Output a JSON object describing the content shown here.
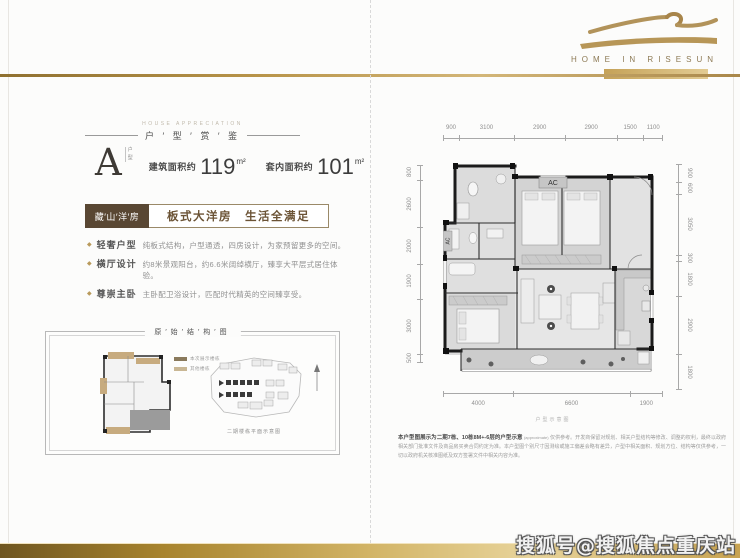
{
  "logo": {
    "wordmark": "HOME IN RISESUN"
  },
  "watermark": {
    "text": "搜狐号@搜狐焦点重庆站"
  },
  "left_panel": {
    "section_header": {
      "en": "HOUSE APPRECIATION",
      "zh": "户 ′ 型 ′ 赏 ′ 鉴"
    },
    "unit": {
      "letter": "A",
      "letter_tag": "户型",
      "areas": [
        {
          "label": "建筑面积约",
          "value": "119",
          "unit": "m²"
        },
        {
          "label": "套内面积约",
          "value": "101",
          "unit": "m²"
        }
      ]
    },
    "banner": {
      "tag": "藏′山′洋′房",
      "slogan": "板式大洋房　生活全满足"
    },
    "features": [
      {
        "title": "轻奢户型",
        "desc": "纯板式结构，户型通透，四房设计，为家预留更多的空间。"
      },
      {
        "title": "横厅设计",
        "desc": "约8米景观阳台，约6.6米阔绰横厅，臻享大平层式居住体验。"
      },
      {
        "title": "尊崇主卧",
        "desc": "主卧配卫浴设计，匹配时代精英的空间臻享受。"
      }
    ],
    "structure_box": {
      "title": "原′始′结′构′图",
      "legend": [
        {
          "swatch": "#8a7a5c",
          "label": "本次展示楼栋"
        },
        {
          "swatch": "#c9b794",
          "label": "其他楼栋"
        }
      ],
      "site_caption": "二期楼栋平面示意图"
    }
  },
  "floor_plan": {
    "ac_label": "AC",
    "caption": "户型示意图",
    "dims_top": [
      "900",
      "3100",
      "2900",
      "2900",
      "1500",
      "1100"
    ],
    "dims_bottom": [
      "4000",
      "6600",
      "1900"
    ],
    "dims_left": [
      "800",
      "2600",
      "2000",
      "1900",
      "3000",
      "500"
    ],
    "dims_right": [
      "900",
      "600",
      "3050",
      "300",
      "1800",
      "2900",
      "1800"
    ]
  },
  "disclaimer": {
    "lead": "本户型图展示为二期7栋、10栋8M+-6层的户型示意",
    "note": "(approximate)",
    "body": "仅供参考。开发商保留对规划、相关户型结构等修改、调整的权利，最终以政府相关部门批准文件及商品房买卖合同约定为准。本户型图个别尺寸因测绘或施工偏差会略有差异，户型中相关面积、规划方位、结构等仅供参考，一切以政府机关核准图纸及双方签署文件中相关内容为准。"
  }
}
